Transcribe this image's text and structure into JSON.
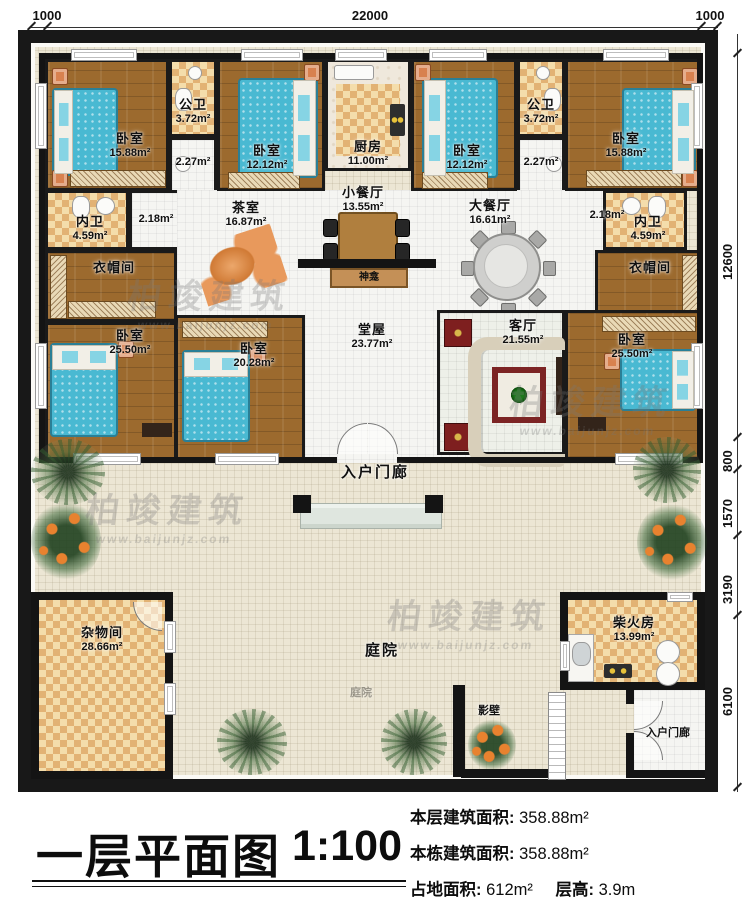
{
  "watermark": {
    "brand": "柏竣建筑",
    "url": "www.baijunjz.com"
  },
  "dimensions": {
    "top": [
      "1000",
      "22000",
      "1000"
    ],
    "right": [
      "12600",
      "800",
      "1570",
      "3190",
      "6100"
    ]
  },
  "rooms": {
    "bedroom_tl": {
      "name": "卧室",
      "area": "15.88m²"
    },
    "bath_pub_l": {
      "name": "公卫",
      "area": "3.72m²"
    },
    "hall_227_l": {
      "area": "2.27m²"
    },
    "bedroom_t2": {
      "name": "卧室",
      "area": "12.12m²"
    },
    "kitchen": {
      "name": "厨房",
      "area": "11.00m²"
    },
    "bedroom_t3": {
      "name": "卧室",
      "area": "12.12m²"
    },
    "bath_pub_r": {
      "name": "公卫",
      "area": "3.72m²"
    },
    "hall_227_r": {
      "area": "2.27m²"
    },
    "bedroom_tr": {
      "name": "卧室",
      "area": "15.88m²"
    },
    "bath_in_l": {
      "name": "内卫",
      "area": "4.59m²"
    },
    "hall_218_l": {
      "area": "2.18m²"
    },
    "tea_room": {
      "name": "茶室",
      "area": "16.87m²"
    },
    "dining_small": {
      "name": "小餐厅",
      "area": "13.55m²"
    },
    "dining_large": {
      "name": "大餐厅",
      "area": "16.61m²"
    },
    "hall_218_r": {
      "area": "2.18m²"
    },
    "bath_in_r": {
      "name": "内卫",
      "area": "4.59m²"
    },
    "cloak_l": {
      "name": "衣帽间"
    },
    "cloak_r": {
      "name": "衣帽间"
    },
    "bedroom_ml": {
      "name": "卧室",
      "area": "25.50m²"
    },
    "bedroom_mc": {
      "name": "卧室",
      "area": "20.28m²"
    },
    "main_hall": {
      "name": "堂屋",
      "area": "23.77m²"
    },
    "living_room": {
      "name": "客厅",
      "area": "21.55m²"
    },
    "bedroom_mr": {
      "name": "卧室",
      "area": "25.50m²"
    },
    "shrine": {
      "name": "神龛"
    },
    "porch_main": {
      "name": "入户门廊"
    },
    "storage": {
      "name": "杂物间",
      "area": "28.66m²"
    },
    "courtyard": {
      "name": "庭院"
    },
    "firewood": {
      "name": "柴火房",
      "area": "13.99m²"
    },
    "screen_wall": {
      "name": "影壁"
    },
    "porch_side": {
      "name": "入户门廊"
    }
  },
  "title_block": {
    "title": "一层平面图",
    "scale": "1:100",
    "stats": [
      {
        "label": "本层建筑面积:",
        "value": "358.88m²"
      },
      {
        "label": "本栋建筑面积:",
        "value": "358.88m²"
      },
      {
        "label": "占地面积:",
        "value": "612m²",
        "label2": "层高:",
        "value2": "3.9m"
      }
    ]
  }
}
